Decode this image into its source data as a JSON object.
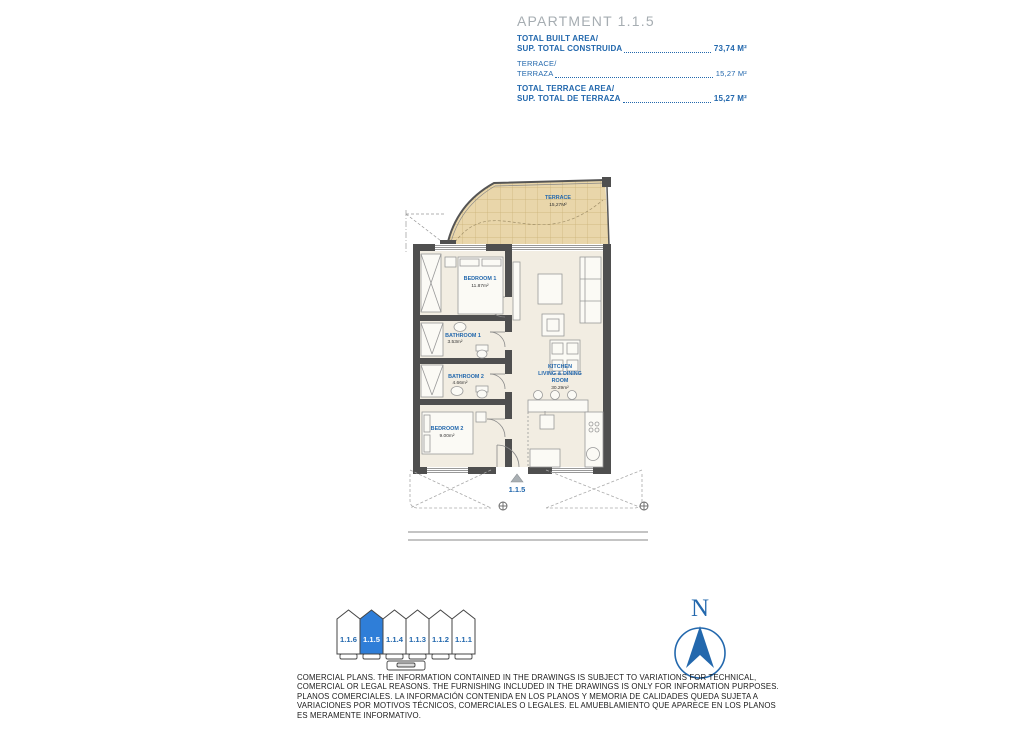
{
  "title_block": {
    "title": "APARTMENT 1.1.5",
    "rows": [
      {
        "label_en": "TOTAL BUILT AREA/",
        "label_es": "SUP. TOTAL CONSTRUIDA",
        "value": "73,74 M²"
      },
      {
        "label_en": "TERRACE/",
        "label_es": "TERRAZA",
        "value": "15,27 M²"
      },
      {
        "label_en": "TOTAL TERRACE AREA/",
        "label_es": "SUP. TOTAL DE TERRAZA",
        "value": "15,27 M²"
      }
    ]
  },
  "floor_plan": {
    "rooms": {
      "terrace": {
        "name": "TERRACE",
        "area": "15,27M²"
      },
      "bedroom1": {
        "name": "BEDROOM 1",
        "area": "11.87m²"
      },
      "bathroom1": {
        "name": "BATHROOM 1",
        "area": "3.53m²"
      },
      "bathroom2": {
        "name": "BATHROOM 2",
        "area": "4.66m²"
      },
      "bedroom2": {
        "name": "BEDROOM 2",
        "area": "9.00m²"
      },
      "kitchen": {
        "name_line1": "KITCHEN",
        "name_line2": "LIVING & DINING",
        "name_line3": "ROOM",
        "area": "30.29m²"
      }
    },
    "entrance_label": "1.1.5"
  },
  "key_plan": {
    "units": [
      {
        "label": "1.1.6",
        "selected": false
      },
      {
        "label": "1.1.5",
        "selected": true
      },
      {
        "label": "1.1.4",
        "selected": false
      },
      {
        "label": "1.1.3",
        "selected": false
      },
      {
        "label": "1.1.2",
        "selected": false
      },
      {
        "label": "1.1.1",
        "selected": false
      }
    ]
  },
  "compass": {
    "north_label": "N"
  },
  "disclaimer": {
    "lines": [
      "COMERCIAL PLANS. THE INFORMATION CONTAINED IN THE DRAWINGS IS SUBJECT TO VARIATIONS FOR TECHNICAL,",
      "COMERCIAL OR LEGAL REASONS. THE FURNISHING INCLUDED IN THE DRAWINGS IS ONLY FOR INFORMATION PURPOSES.",
      "PLANOS COMERCIALES. LA INFORMACIÓN CONTENIDA EN LOS PLANOS Y MEMORIA DE CALIDADES QUEDA SUJETA A",
      "VARIACIONES POR MOTIVOS TÉCNICOS, COMERCIALES O LEGALES. EL AMUEBLAMIENTO QUE APARECE EN LOS PLANOS",
      "ES MERAMENTE INFORMATIVO."
    ]
  },
  "colors": {
    "accent_blue": "#2368ad",
    "selected_unit_fill": "#2f7ed8",
    "terrace_fill": "#e9d6aa",
    "wall": "#4f4f4f",
    "floor_fill": "#f2ede2",
    "title_gray": "#a6adb2"
  }
}
